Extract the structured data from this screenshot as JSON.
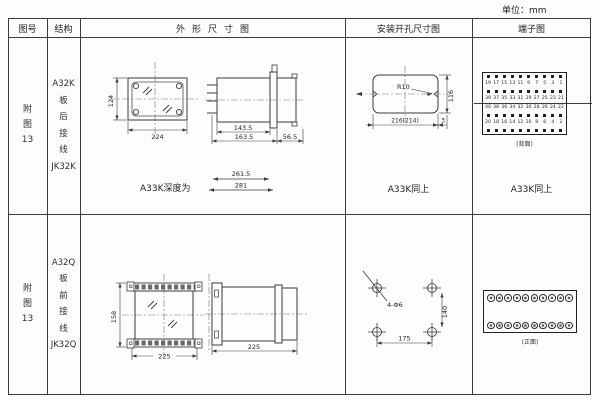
{
  "unit_note": "单位：mm",
  "header": {
    "figure_no": "图号",
    "structure": "结构",
    "outline": "外形尺寸图",
    "mounting": "安装开孔尺寸图",
    "terminal": "端子图"
  },
  "row1": {
    "figure_no": {
      "l1": "附",
      "l2": "图",
      "l3": "13"
    },
    "structure": {
      "model": "A32K",
      "c1": "板",
      "c2": "后",
      "c3": "接",
      "c4": "线",
      "jk": "JK32K"
    },
    "outline": {
      "height": "124",
      "width": "224",
      "depth_body": "143.5",
      "depth_total": "163.5",
      "flange_depth": "56.5",
      "depth_note": "A33K深度为",
      "depth_alt1": "261.5",
      "depth_alt2": "281"
    },
    "mounting": {
      "corner_radius": "R10",
      "cutout_width": "216(214)",
      "cutout_height": "116",
      "edge_gap": "3",
      "same_as": "A33K同上"
    },
    "terminal": {
      "rows": {
        "r1": [
          "19",
          "17",
          "15",
          "13",
          "11",
          "9",
          "7",
          "5",
          "3",
          "1"
        ],
        "r2": [
          "39",
          "37",
          "35",
          "33",
          "31",
          "29",
          "27",
          "25",
          "23",
          "21"
        ],
        "r3": [
          "40",
          "38",
          "36",
          "34",
          "32",
          "30",
          "28",
          "26",
          "24",
          "22"
        ],
        "r4": [
          "20",
          "18",
          "16",
          "14",
          "12",
          "10",
          "8",
          "6",
          "4",
          "2"
        ]
      },
      "caption": "(背面)",
      "same_as": "A33K同上"
    }
  },
  "row2": {
    "figure_no": {
      "l1": "附",
      "l2": "图",
      "l3": "13"
    },
    "structure": {
      "model": "A32Q",
      "c1": "板",
      "c2": "前",
      "c3": "接",
      "c4": "线",
      "jk": "JK32Q"
    },
    "outline": {
      "height": "158",
      "width": "225",
      "depth": "225"
    },
    "mounting": {
      "holes": "4-Φ6",
      "hole_spacing_v": "140",
      "hole_spacing_h": "175"
    },
    "terminal": {
      "caption": "(正面)"
    }
  }
}
